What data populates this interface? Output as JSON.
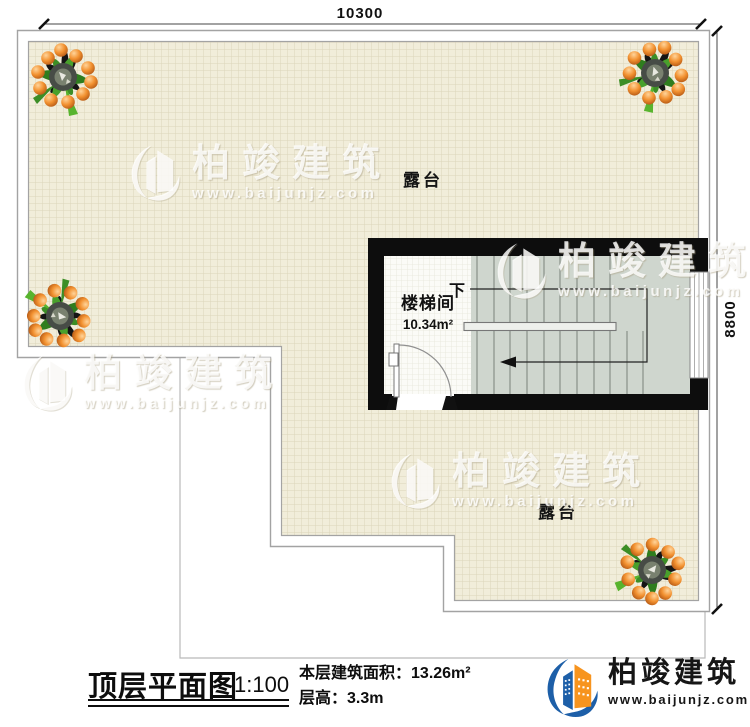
{
  "dimensions": {
    "width": "10300",
    "height": "8800"
  },
  "plan": {
    "terrace_label_top": "露台",
    "terrace_label_bottom": "露台",
    "stairwell": {
      "name": "楼梯间",
      "area": "10.34m²",
      "direction": "下"
    }
  },
  "watermark": {
    "brand": "柏竣建筑",
    "url": "www.baijunjz.com"
  },
  "footer": {
    "title": "顶层平面图",
    "scale": "1:100",
    "area_label": "本层建筑面积：",
    "area_value": "13.26m²",
    "floor_height_label": "层高：",
    "floor_height_value": "3.3m",
    "brand": "柏竣建筑",
    "brand_url": "www.baijunjz.com"
  },
  "colors": {
    "brand_blue": "#1d5fa8",
    "brand_orange": "#f7941e",
    "wall_black": "#0d0d0d",
    "terrace_fill": "#f1edda",
    "stair_fill": "#cfd6ce"
  }
}
